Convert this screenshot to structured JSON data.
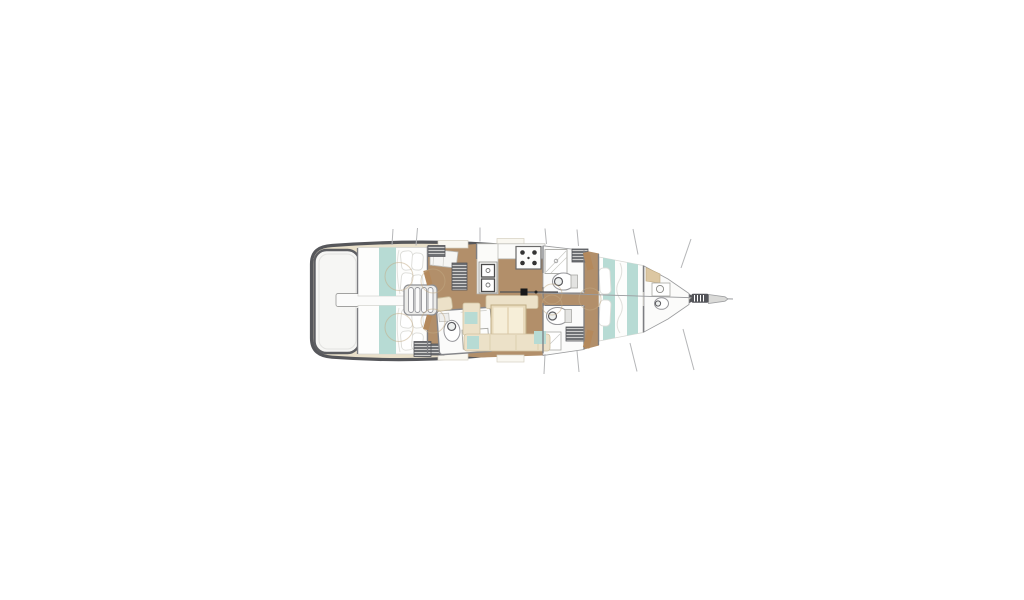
{
  "window": {
    "background": "#ffffff",
    "width": 1024,
    "height": 600
  },
  "diagram": {
    "kind": "sailboat-floor-plan",
    "view": "top-down",
    "bow_direction": "right",
    "stern_direction": "left",
    "areas": [
      {
        "name": "swim-platform"
      },
      {
        "name": "aft-cabin-port"
      },
      {
        "name": "aft-cabin-starboard"
      },
      {
        "name": "companionway-steps"
      },
      {
        "name": "aft-head"
      },
      {
        "name": "galley"
      },
      {
        "name": "salon"
      },
      {
        "name": "head-port"
      },
      {
        "name": "head-starboard"
      },
      {
        "name": "mast"
      },
      {
        "name": "forward-cabin"
      },
      {
        "name": "forward-head"
      },
      {
        "name": "bowsprit"
      },
      {
        "name": "rigging-lines"
      }
    ],
    "colors": {
      "hull_outline": "#56575b",
      "deck_cream": "#e9e0ca",
      "wood_floor": "#b28f6a",
      "room_white": "#fbfbfa",
      "fixture_white": "#ffffff",
      "bedding_teal": "#b7dbd4",
      "bedding_white": "#fdfdfc",
      "upholstery_cream": "#ece1c8",
      "upholstery_panel": "#f6eed8",
      "table_wood": "#e8dabc",
      "hatch_dark": "#6f7174",
      "wall_gray": "#7d7e82",
      "door_tan": "#b4895c",
      "door_arc": "#c2aa84",
      "rigging_gray": "#b5b6b8",
      "steps_gray": "#ececea",
      "mast_black": "#17181a",
      "platform_white": "#f6f6f4"
    }
  }
}
